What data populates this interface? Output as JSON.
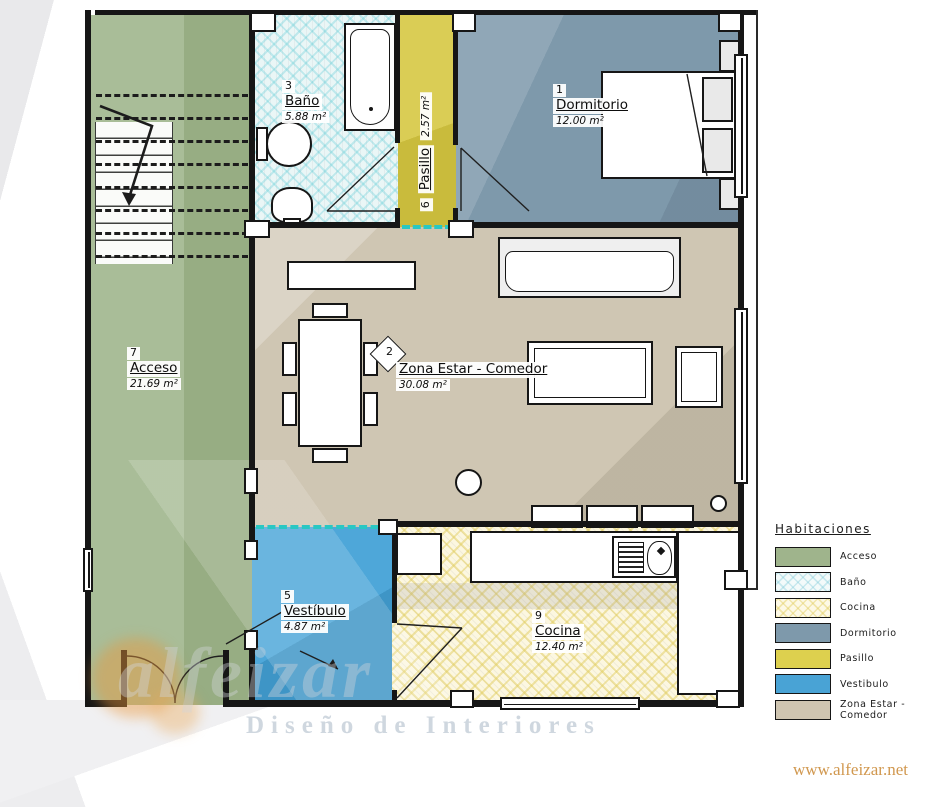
{
  "plan": {
    "rooms": {
      "dormitorio": {
        "num": "1",
        "name": "Dormitorio",
        "area": "12.00 m²",
        "color": "#7e99ab"
      },
      "zona": {
        "num": "2",
        "name": "Zona Estar - Comedor",
        "area": "30.08 m²",
        "color": "#cfc6b3"
      },
      "bano": {
        "num": "3",
        "name": "Baño",
        "area": "5.88 m²",
        "color": "#eaf6f6"
      },
      "vestibulo": {
        "num": "5",
        "name": "Vestíbulo",
        "area": "4.87 m²",
        "color": "#49a3d5"
      },
      "pasillo": {
        "num": "6",
        "name": "Pasillo",
        "area": "2.57 m²",
        "color": "#d8cb4f"
      },
      "acceso": {
        "num": "7",
        "name": "Acceso",
        "area": "21.69 m²",
        "color": "#9fb48c"
      },
      "cocina": {
        "num": "9",
        "name": "Cocina",
        "area": "12.40 m²",
        "color": "#fcf7e0"
      }
    }
  },
  "legend": {
    "title": "Habitaciones",
    "items": [
      {
        "label": "Acceso",
        "color": "#9fb48c"
      },
      {
        "label": "Baño",
        "color": "#f3fafa"
      },
      {
        "label": "Cocina",
        "color": "#fdf9e6"
      },
      {
        "label": "Dormitorio",
        "color": "#7e99ab"
      },
      {
        "label": "Pasillo",
        "color": "#ddd04e"
      },
      {
        "label": "Vestibulo",
        "color": "#49a3d5"
      },
      {
        "label": "Zona Estar - Comedor",
        "color": "#cfc5b1"
      }
    ]
  },
  "watermark": {
    "brand": "alfeizar",
    "tagline": "Diseño de Interiores",
    "website": "www.alfeizar.net"
  }
}
